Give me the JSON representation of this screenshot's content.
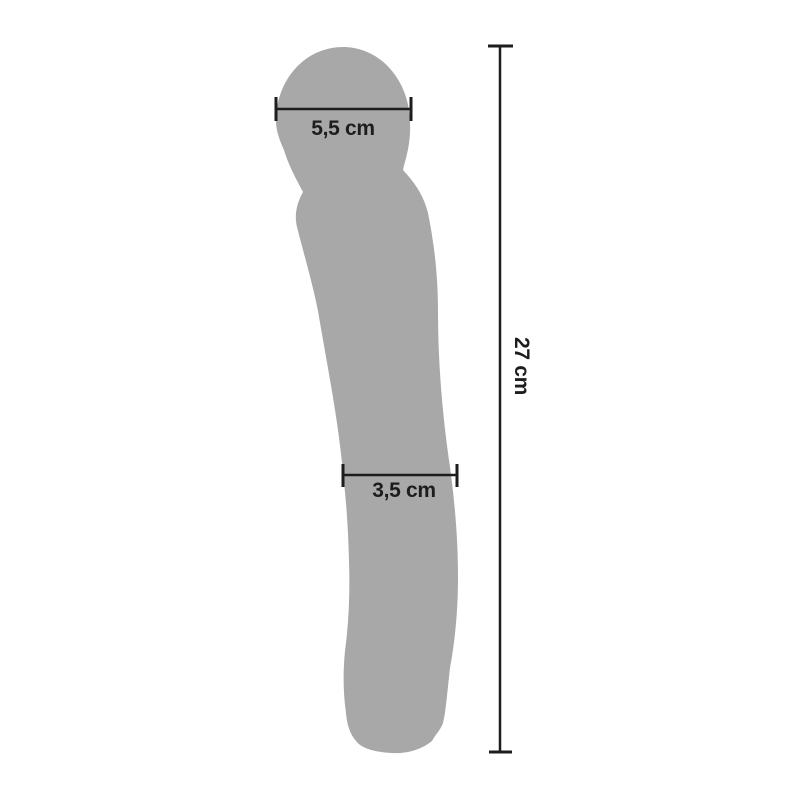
{
  "diagram": {
    "type": "product-dimension-diagram",
    "object_name": "wand-massager-silhouette",
    "background_color": "#ffffff",
    "silhouette_color": "#a8a8a8",
    "dimension_color": "#1d1d1d"
  },
  "measurements": {
    "head_width": "5,5 cm",
    "shaft_width": "3,5 cm",
    "total_length": "27 cm"
  }
}
